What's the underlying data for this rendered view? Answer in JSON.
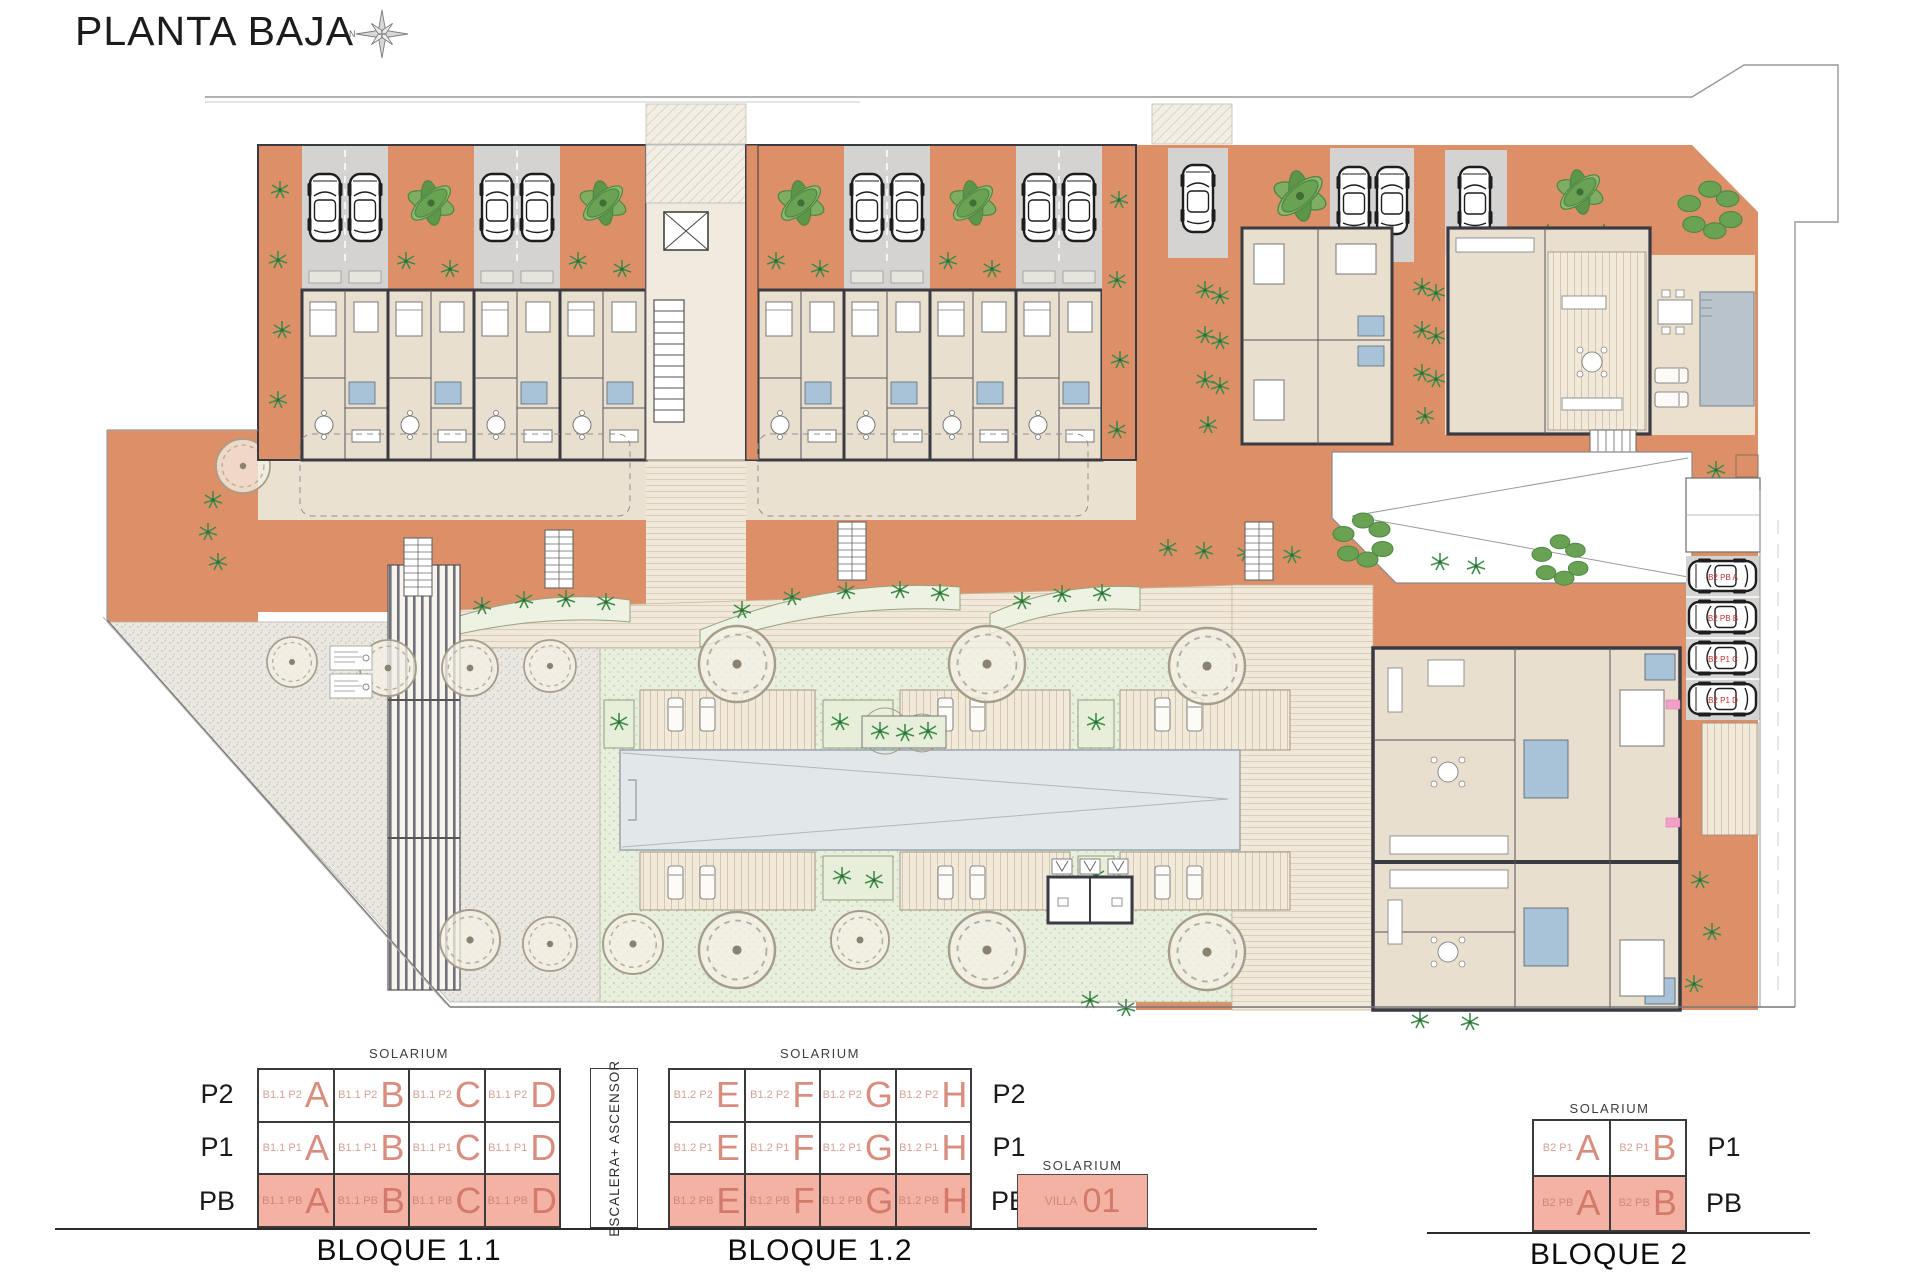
{
  "title": "PLANTA BAJA",
  "compass_label": "N",
  "legend": {
    "solarium_label": "SOLARIUM",
    "floors": [
      "P2",
      "P1",
      "PB"
    ],
    "floors_b2": [
      "P1",
      "PB"
    ],
    "escalera_label": "ESCALERA+ ASCENSOR",
    "b11": {
      "caption": "BLOQUE 1.1",
      "rows": [
        {
          "cells": [
            {
              "code": "B1.1 P2",
              "letter": "A"
            },
            {
              "code": "B1.1 P2",
              "letter": "B"
            },
            {
              "code": "B1.1 P2",
              "letter": "C"
            },
            {
              "code": "B1.1 P2",
              "letter": "D"
            }
          ]
        },
        {
          "cells": [
            {
              "code": "B1.1 P1",
              "letter": "A"
            },
            {
              "code": "B1.1 P1",
              "letter": "B"
            },
            {
              "code": "B1.1 P1",
              "letter": "C"
            },
            {
              "code": "B1.1 P1",
              "letter": "D"
            }
          ]
        },
        {
          "cells": [
            {
              "code": "B1.1 PB",
              "letter": "A"
            },
            {
              "code": "B1.1 PB",
              "letter": "B"
            },
            {
              "code": "B1.1 PB",
              "letter": "C"
            },
            {
              "code": "B1.1 PB",
              "letter": "D"
            }
          ]
        }
      ]
    },
    "b12": {
      "caption": "BLOQUE 1.2",
      "rows": [
        {
          "cells": [
            {
              "code": "B1.2 P2",
              "letter": "E"
            },
            {
              "code": "B1.2 P2",
              "letter": "F"
            },
            {
              "code": "B1.2 P2",
              "letter": "G"
            },
            {
              "code": "B1.2 P2",
              "letter": "H"
            }
          ]
        },
        {
          "cells": [
            {
              "code": "B1.2 P1",
              "letter": "E"
            },
            {
              "code": "B1.2 P1",
              "letter": "F"
            },
            {
              "code": "B1.2 P1",
              "letter": "G"
            },
            {
              "code": "B1.2 P1",
              "letter": "H"
            }
          ]
        },
        {
          "cells": [
            {
              "code": "B1.2 PB",
              "letter": "E"
            },
            {
              "code": "B1.2 PB",
              "letter": "F"
            },
            {
              "code": "B1.2 PB",
              "letter": "G"
            },
            {
              "code": "B1.2 PB",
              "letter": "H"
            }
          ]
        }
      ]
    },
    "villa": {
      "solarium": "SOLARIUM",
      "name": "VILLA",
      "number": "01"
    },
    "b2": {
      "caption": "BLOQUE 2",
      "rows": [
        {
          "cells": [
            {
              "code": "B2 P1",
              "letter": "A"
            },
            {
              "code": "B2 P1",
              "letter": "B"
            }
          ]
        },
        {
          "cells": [
            {
              "code": "B2 PB",
              "letter": "A"
            },
            {
              "code": "B2 PB",
              "letter": "B"
            }
          ]
        }
      ]
    }
  },
  "plan": {
    "parking_labels": [
      "B2 PB A",
      "B2 PB B",
      "B2 P1 C",
      "B2 P1 D"
    ]
  },
  "colors": {
    "terracotta": "#DD9068",
    "interior_beige": "#E9DFCF",
    "bath_blue": "#A8C2D8",
    "pool": "#E2E8E9",
    "salmon_bg": "#F3B2A4",
    "salmon_text": "#D98D7E",
    "wall": "#3A3A42"
  }
}
